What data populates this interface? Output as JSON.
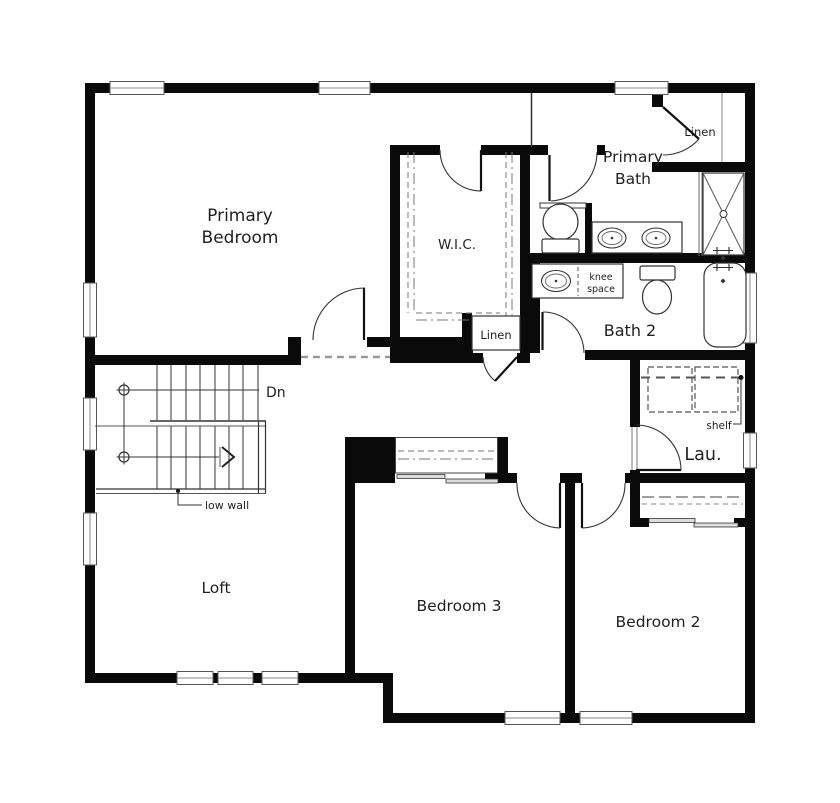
{
  "canvas": {
    "width": 840,
    "height": 803,
    "background": "#ffffff",
    "wall_color": "#0a0a0a",
    "line_color": "#3a3a3a",
    "dash_color": "#777777",
    "text_color": "#1f1f1f"
  },
  "rooms": {
    "primary_bedroom": {
      "line1": "Primary",
      "line2": "Bedroom"
    },
    "primary_bath": {
      "line1": "Primary",
      "line2": "Bath"
    },
    "wic": {
      "label": "W.I.C."
    },
    "linen_primary": {
      "label": "Linen"
    },
    "linen_hall": {
      "label": "Linen"
    },
    "bath2": {
      "label": "Bath 2"
    },
    "laundry": {
      "label": "Lau."
    },
    "loft": {
      "label": "Loft"
    },
    "bedroom3": {
      "label": "Bedroom 3"
    },
    "bedroom2": {
      "label": "Bedroom 2"
    }
  },
  "annotations": {
    "stair_direction": "Dn",
    "low_wall": "low wall",
    "knee_line1": "knee",
    "knee_line2": "space",
    "shelf": "shelf"
  }
}
